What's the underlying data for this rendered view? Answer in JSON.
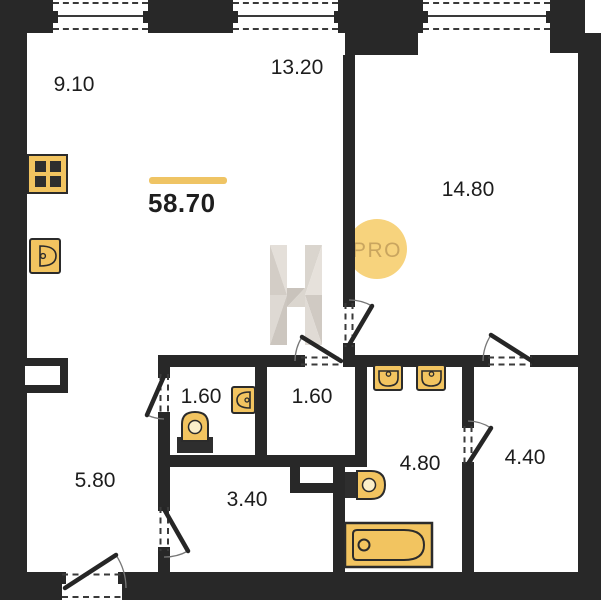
{
  "title": "apartment-floor-plan",
  "total": {
    "area_label": "58.70"
  },
  "rooms": [
    {
      "name": "kitchen",
      "area": "9.10"
    },
    {
      "name": "living",
      "area": "13.20"
    },
    {
      "name": "bedroom",
      "area": "14.80"
    },
    {
      "name": "wc",
      "area": "1.60"
    },
    {
      "name": "storage",
      "area": "1.60"
    },
    {
      "name": "hallway",
      "area": "5.80"
    },
    {
      "name": "corridor",
      "area": "3.40"
    },
    {
      "name": "bathroom",
      "area": "4.80"
    },
    {
      "name": "wardrobe",
      "area": "4.40"
    }
  ],
  "watermark": {
    "letter": "H",
    "badge_text": "PRO"
  },
  "colors": {
    "wall": "#282828",
    "fixture_fill": "#F2C460",
    "accent_line": "#EFC464",
    "badge_bg": "#F7D37D",
    "badge_text": "#C9A55F",
    "watermark_gray": "#D6D1CA"
  }
}
